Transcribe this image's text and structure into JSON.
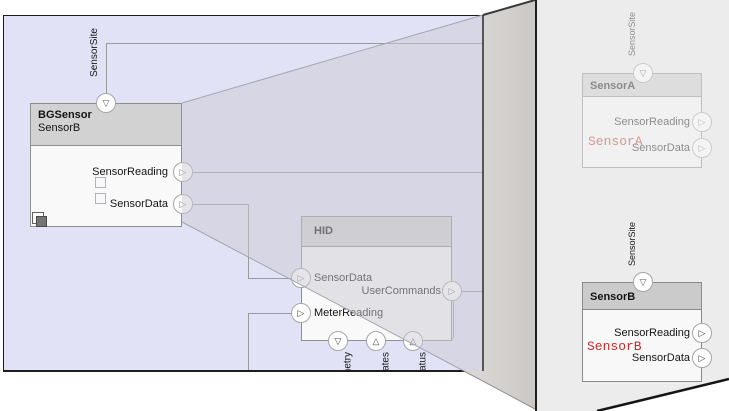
{
  "colors": {
    "diagram_bg": "#e2e2f6",
    "panel_bg": "#ececec",
    "accent_red": "#c62a2a",
    "block_header_gray": "#d2d2d2",
    "connector_gray": "#9a9a9a"
  },
  "icons": {
    "port_right": "▷",
    "port_down": "▽",
    "port_up": "△"
  },
  "diagram": {
    "bgsensor": {
      "type_label": "BGSensor",
      "name_label": "SensorB",
      "top_port_label": "SensorSite",
      "output_ports": [
        "SensorReading",
        "SensorData"
      ]
    },
    "hid": {
      "title": "HID",
      "input_ports": [
        "SensorData",
        "MeterReading"
      ],
      "output_port": "UserCommands",
      "bottom_port_labels": [
        "Telemetry",
        "Updates",
        "Status"
      ]
    }
  },
  "panel": {
    "variant_a": {
      "header": "SensorA",
      "top_port_label": "SensorSite",
      "output_ports": [
        "SensorReading",
        "SensorData"
      ],
      "code_label": "SensorA"
    },
    "variant_b": {
      "header": "SensorB",
      "top_port_label": "SensorSite",
      "output_ports": [
        "SensorReading",
        "SensorData"
      ],
      "code_label": "SensorB"
    }
  }
}
